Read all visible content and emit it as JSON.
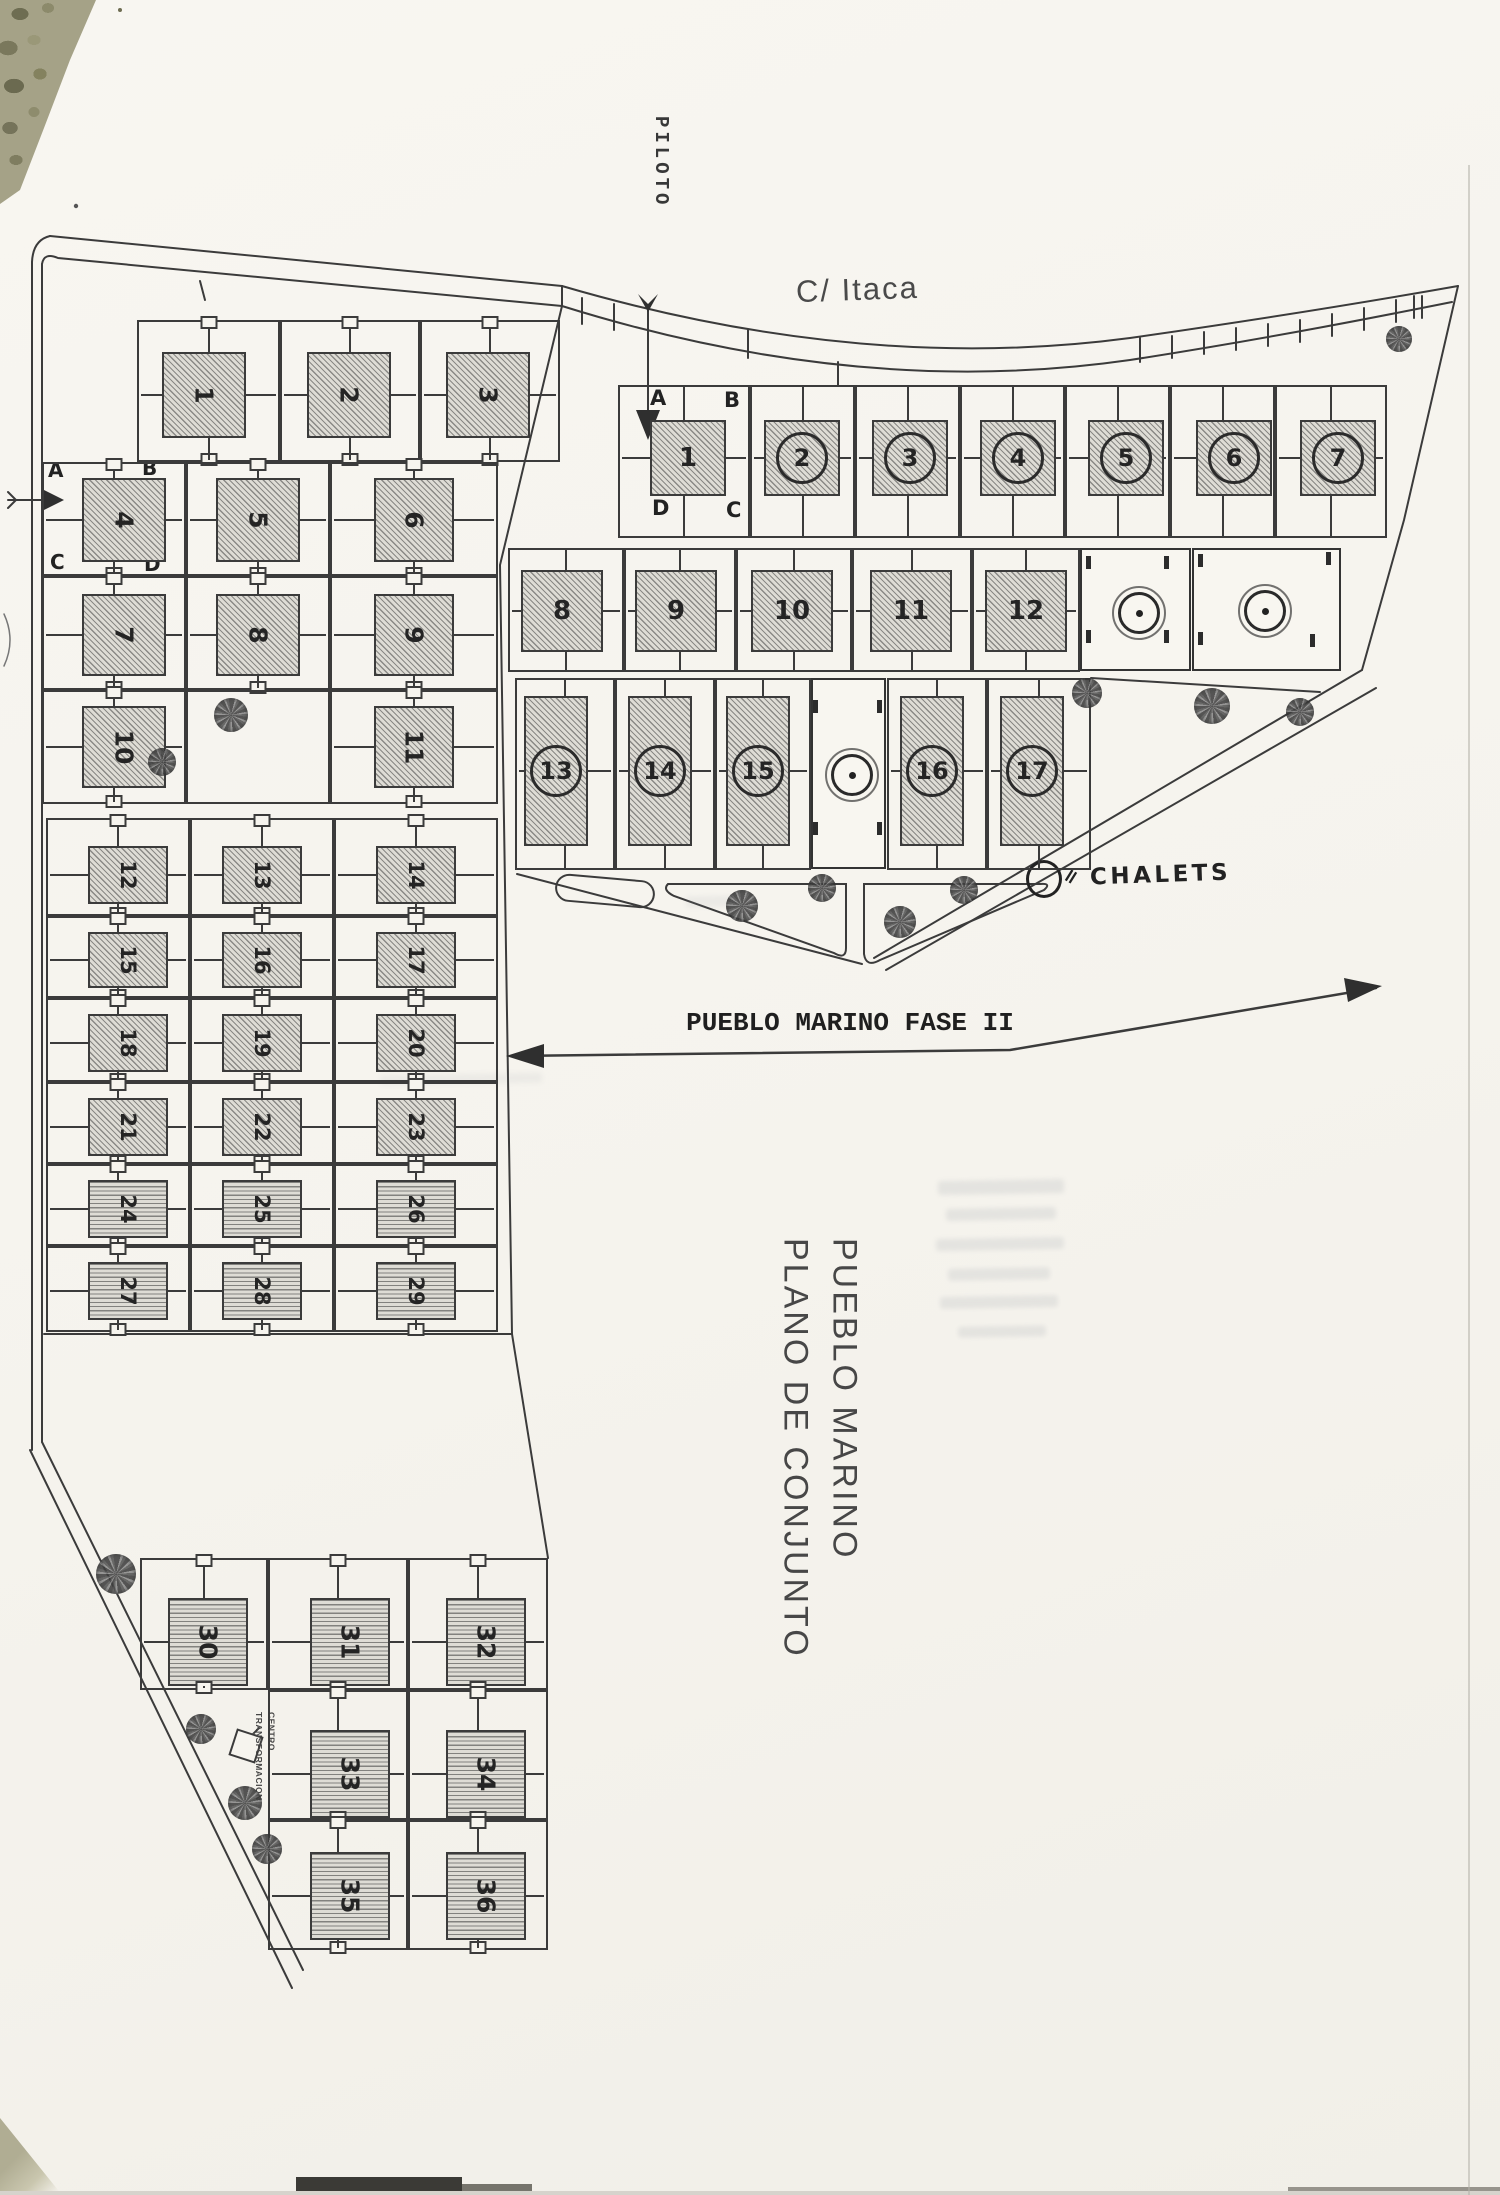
{
  "page": {
    "street_label": "C/ Itaca",
    "pilot_label": "PILOTO",
    "phase2_banner": "PUEBLO MARINO FASE II",
    "legend": {
      "icon": "circle-icon",
      "separator": "=",
      "label": "CHALETS"
    },
    "title": {
      "line1": "PUEBLO MARINO",
      "line2": "PLANO DE CONJUNTO"
    },
    "transformer_label": {
      "line1": "CENTRO",
      "line2": "TRANSFORMACION"
    }
  },
  "phase1": {
    "corner_labels": {
      "top_left": "A",
      "top_right": "B",
      "bottom_left": "C",
      "bottom_right": "D"
    },
    "rows": [
      [
        "1",
        "2",
        "3"
      ],
      [
        "4",
        "5",
        "6"
      ],
      [
        "7",
        "8",
        "9"
      ],
      [
        "10",
        "",
        "11"
      ],
      [
        "12",
        "13",
        "14"
      ],
      [
        "15",
        "16",
        "17"
      ],
      [
        "18",
        "19",
        "20"
      ],
      [
        "21",
        "22",
        "23"
      ],
      [
        "24",
        "25",
        "26"
      ],
      [
        "27",
        "28",
        "29"
      ]
    ],
    "bottom_rows": [
      [
        "30",
        "31",
        "32"
      ],
      [
        "",
        "33",
        "34"
      ],
      [
        "",
        "35",
        "36"
      ]
    ]
  },
  "phase2": {
    "corner_labels": {
      "top_left": "A",
      "top_right": "B",
      "bottom_left": "D",
      "bottom_right": "C"
    },
    "row1": [
      "1",
      "2",
      "3",
      "4",
      "5",
      "6",
      "7"
    ],
    "row1_circled": [
      false,
      true,
      true,
      true,
      true,
      true,
      true
    ],
    "row2": [
      "8",
      "9",
      "10",
      "11",
      "12"
    ],
    "row3": [
      "13",
      "14",
      "15",
      "16",
      "17"
    ],
    "chalet_plot_count": 3
  }
}
